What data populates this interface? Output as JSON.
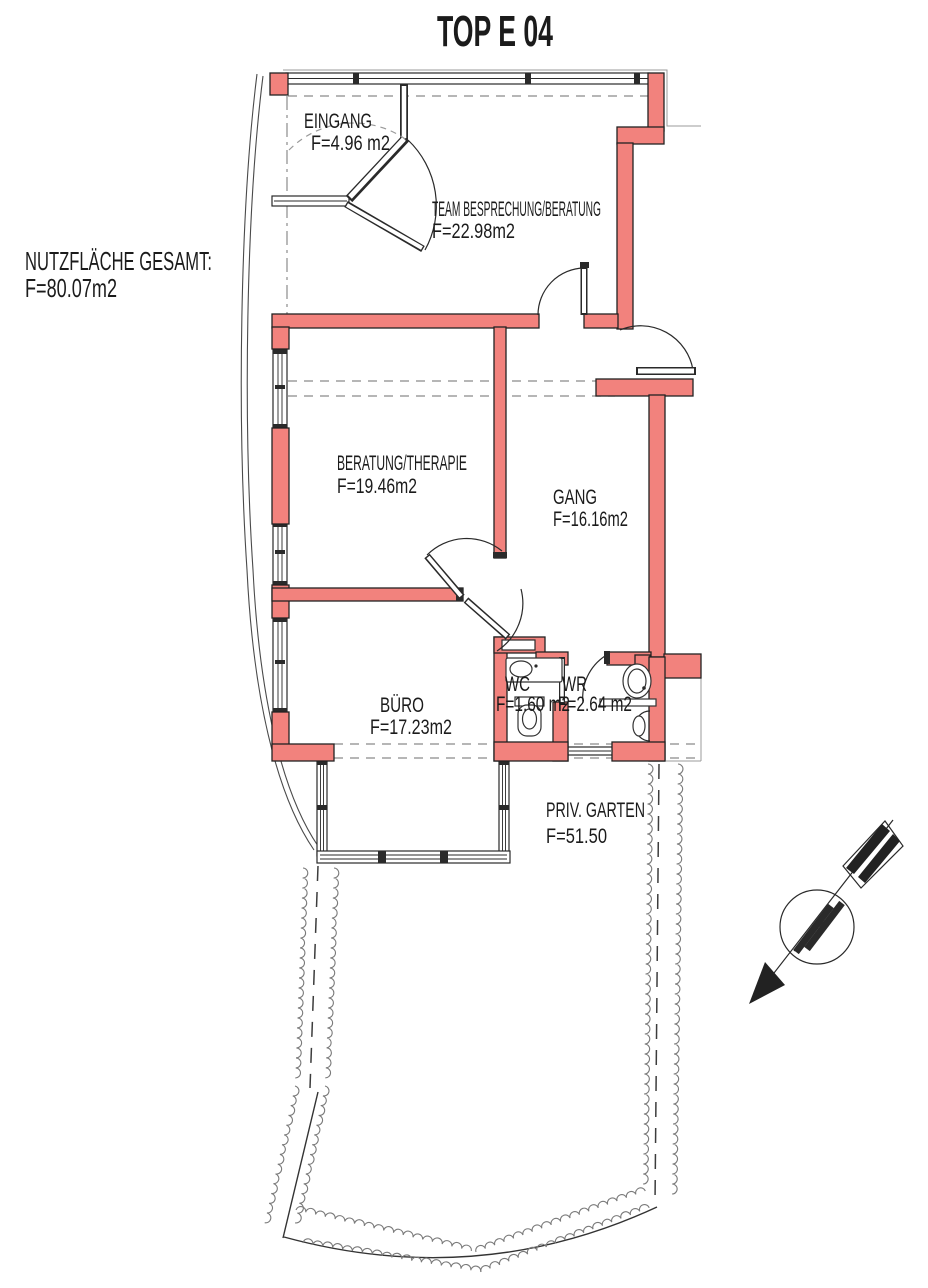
{
  "title": "TOP E 04",
  "summary": {
    "line1": "NUTZFLÄCHE GESAMT:",
    "line2": "F=80.07m2"
  },
  "rooms": [
    {
      "name": "EINGANG",
      "area": "F=4.96 m2"
    },
    {
      "name": "TEAM BESPRECHUNG/BERATUNG",
      "area": "F=22.98m2"
    },
    {
      "name": "BERATUNG/THERAPIE",
      "area": "F=19.46m2"
    },
    {
      "name": "GANG",
      "area": "F=16.16m2"
    },
    {
      "name": "BÜRO",
      "area": "F=17.23m2"
    },
    {
      "name": "WC",
      "area": "F=1.60 m2"
    },
    {
      "name": "WR",
      "area": "F=2.64 m2"
    },
    {
      "name": "PRIV. GARTEN",
      "area": "F=51.50"
    }
  ],
  "icons": {
    "compass": "north-arrow"
  },
  "colors": {
    "wall": "#f2827d",
    "line": "#222222",
    "hedge": "#7a7a7a"
  }
}
